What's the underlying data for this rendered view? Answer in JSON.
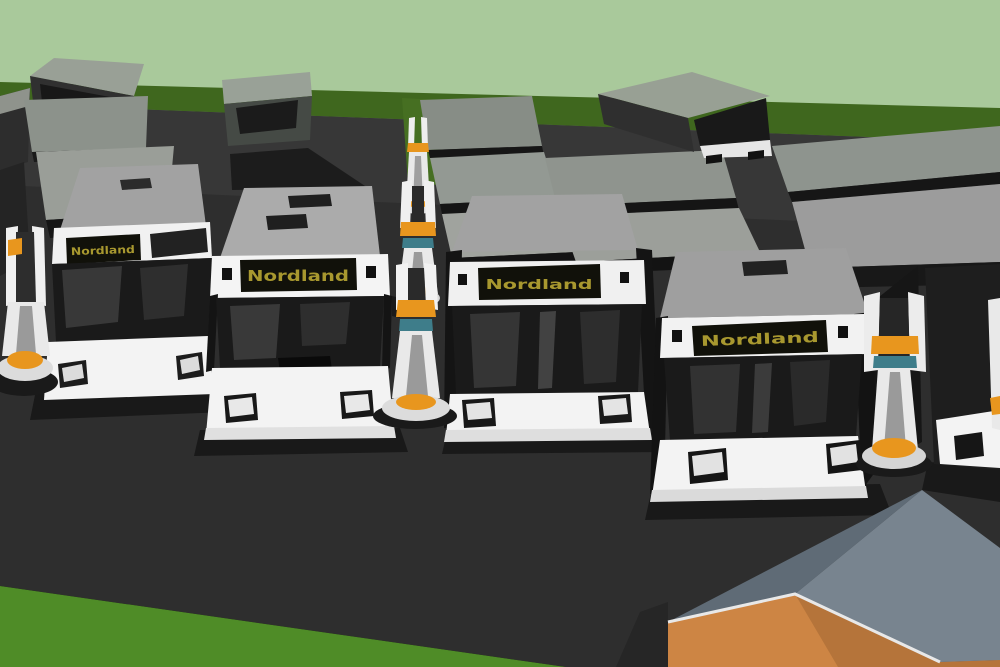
{
  "scene": {
    "description": "3D concept rendering of an electric bus depot: rows of grey buses parked on dark asphalt, white fast-charging pillars with orange bases between the rows, pale green sky, dark green tree line, grass field in the foreground corner and an orange-walled shed with a grey gable roof at bottom right",
    "bus_destination_sign": "Nordland",
    "visible_front_buses": 5,
    "visible_background_buses": 10,
    "visible_charging_pillars": 7
  },
  "colors": {
    "sky": "#a9c99b",
    "horizon_grass": "#3f671e",
    "grass_gap": "#466f22",
    "field_grass": "#4f8c27",
    "asphalt": "#2e2e2e",
    "asphalt_apron": "#373737",
    "bus_roof_grey": "#a2a2a2",
    "bus_white": "#f3f3f3",
    "bus_glass_dark": "#1a1a1a",
    "sign_plate": "#11110a",
    "sign_text": "#a8982f",
    "charger_white": "#e9e9e9",
    "charger_orange": "#e8961e",
    "charger_teal": "#3e7d8a",
    "building_wall": "#cd8544",
    "building_wall_shaded": "#b5743a",
    "building_roof_dark": "#5f6b76",
    "building_roof_light": "#78848f",
    "shadow": "#191919"
  }
}
